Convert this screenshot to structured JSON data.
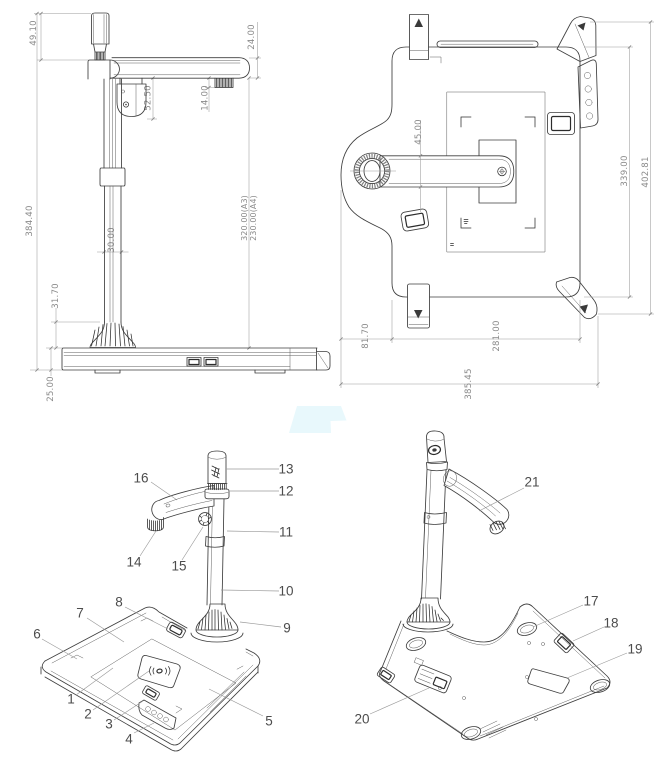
{
  "side_view": {
    "dims": {
      "head_height": "49.10",
      "arm_thickness": "24.00",
      "camera_drop": "52.50",
      "knob_height": "14.00",
      "total_height": "384.40",
      "pole_width": "30.00",
      "work_height_a3": "320.00(A3)",
      "work_height_a4": "230.00(A4)",
      "flare_height": "31.70",
      "base_thickness": "25.00"
    }
  },
  "top_view": {
    "dims": {
      "arm_width": "45.00",
      "base_depth": "339.00",
      "overall_depth": "402.81",
      "lobe_offset": "81.70",
      "base_width": "281.00",
      "overall_width": "385.45"
    }
  },
  "front_iso": {
    "callouts": {
      "c1": "1",
      "c2": "2",
      "c3": "3",
      "c4": "4",
      "c5": "5",
      "c6": "6",
      "c7": "7",
      "c8": "8",
      "c9": "9",
      "c10": "10",
      "c11": "11",
      "c12": "12",
      "c13": "13",
      "c14": "14",
      "c15": "15",
      "c16": "16"
    }
  },
  "rear_iso": {
    "callouts": {
      "c17": "17",
      "c18": "18",
      "c19": "19",
      "c20": "20",
      "c21": "21"
    }
  }
}
